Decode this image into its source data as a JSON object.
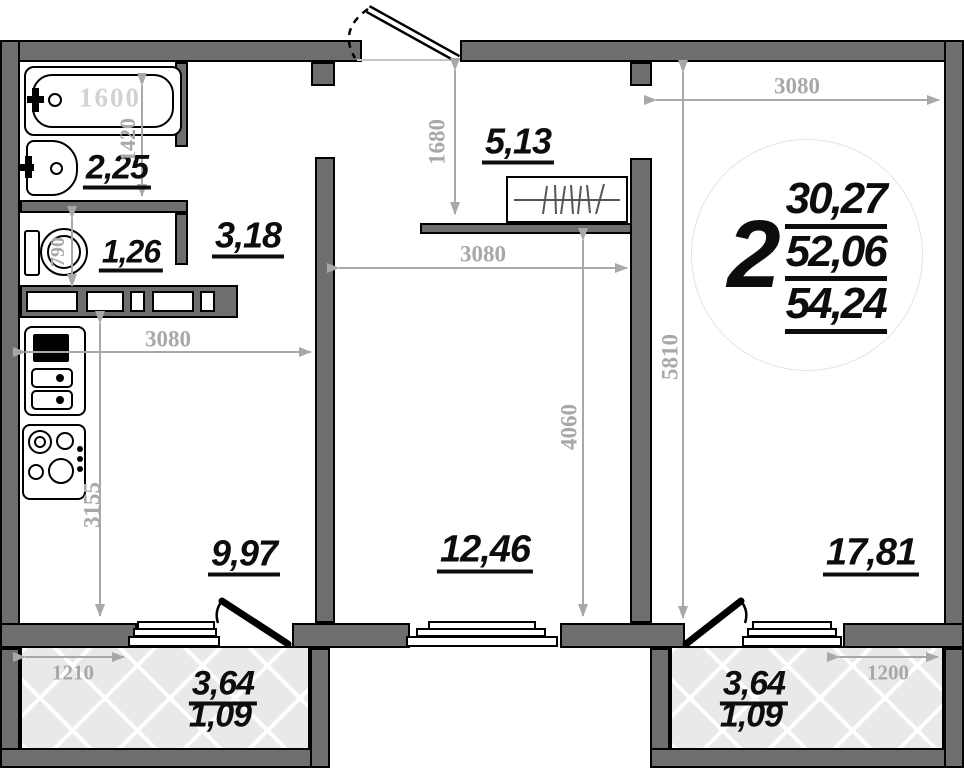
{
  "badge": {
    "rooms": "2",
    "areas": [
      "30,27",
      "52,06",
      "54,24"
    ]
  },
  "rooms": {
    "bathroom": {
      "label": "2,25"
    },
    "wc": {
      "label": "1,26"
    },
    "hallway": {
      "label": "3,18"
    },
    "entry_hall": {
      "label": "5,13"
    },
    "kitchen": {
      "label": "9,97"
    },
    "bedroom": {
      "label": "12,46"
    },
    "living_room": {
      "label": "17,81"
    },
    "balcony_left": {
      "area": "3,64",
      "reduced_area": "1,09"
    },
    "balcony_right": {
      "area": "3,64",
      "reduced_area": "1,09"
    }
  },
  "dimensions": {
    "tub": "1600",
    "bathroom_width": "1420",
    "wc_depth": "790",
    "kitchen_width": "3080",
    "kitchen_depth": "3155",
    "entry_hall_depth": "1680",
    "bedroom_width": "3080",
    "bedroom_depth": "4060",
    "living_width": "3080",
    "living_depth": "5810",
    "balcony_left_width": "1210",
    "balcony_right_width": "1200"
  },
  "colors": {
    "wall": "#6e6e6e",
    "dimension": "#a8a8a8",
    "label": "#0d0d0d",
    "balcony_fill": "#e9e9e9"
  }
}
